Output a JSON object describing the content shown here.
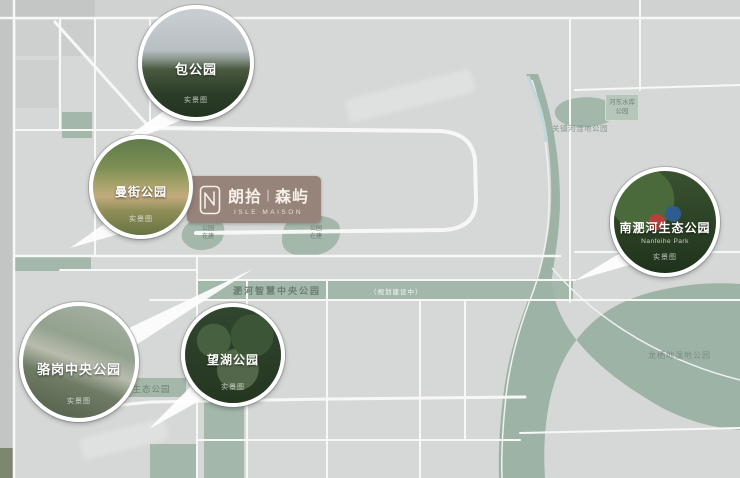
{
  "brand": {
    "cn_left": "朗拾",
    "divider": "∣",
    "cn_right": "森屿",
    "en": "ISLE MAISON"
  },
  "callouts": [
    {
      "label": "包公园",
      "caption": "实景图"
    },
    {
      "label": "曼街公园",
      "caption": "实景图"
    },
    {
      "label": "骆岗中央公园",
      "caption": "实景图"
    },
    {
      "label": "望湖公园",
      "caption": "实景图"
    },
    {
      "label": "南淝河生态公园",
      "sublabel": "Nanfeihe Park",
      "caption": "实景图"
    }
  ],
  "map_labels": {
    "smart_park": "淝河智慧中央公园",
    "smart_park_note": "（规划建设中）",
    "eco_park": "淝河生态公园",
    "longqidi": "龙栖地湿地公园",
    "guanzhenhe": "关镇河湿地公园",
    "hedong_l1": "河东水库",
    "hedong_l2": "公园",
    "blob_left_l1": "公园",
    "blob_left_l2": "在建",
    "blob_right_l1": "公园",
    "blob_right_l2": "在建"
  },
  "colors": {
    "background": "#d6d8d7",
    "sage_green": "#a3b7aa",
    "river_green": "#9db3a6",
    "road_white": "#f7f8f6",
    "marker_brown": "#96837a",
    "marker_text": "#f6f0e8",
    "label_green": "#6e7f73"
  }
}
